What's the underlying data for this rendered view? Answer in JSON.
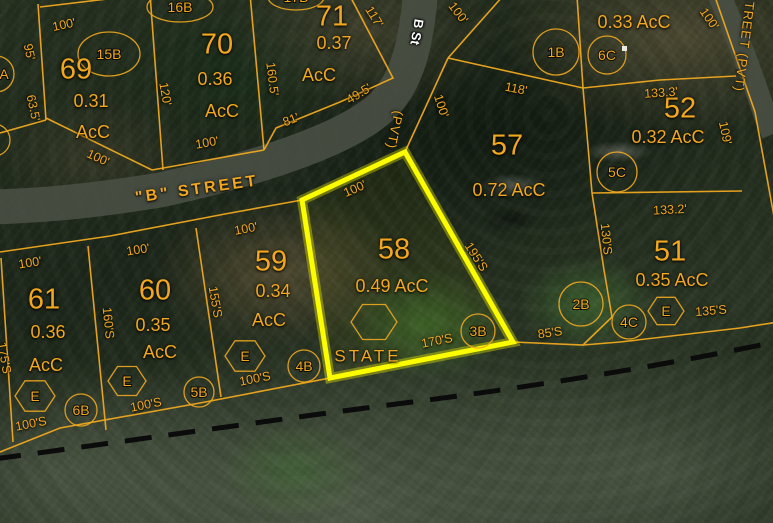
{
  "map": {
    "colors": {
      "boundary": "#efa81f",
      "highlight": "#fcfc00",
      "road": "#4a5044",
      "dashed_line": "#0b0b0b",
      "label": "#f2a71e",
      "street_label_white": "#ffffff"
    },
    "roads": [
      {
        "name": "b-street",
        "path": "M 421,-12 C 417,38 409,84 378,110 C 340,142 252,170 160,190 C 80,203 30,206 -10,207",
        "width": 35
      },
      {
        "name": "right-street",
        "path": "M 717,-10 C 735,30 752,75 766,118 L 773,134",
        "width": 23
      }
    ],
    "boundaries": [
      "38,4 46,120",
      "40,7 132,-4",
      "150,-6 163,170",
      "250,-6 264,150",
      "350,-4 393,78 340,102 276,128 264,150",
      "46,118 152,170",
      "152,170 264,150",
      "46,120 0,133",
      "0,252 110,236 225,214 302,200",
      "1,258 13,442",
      "88,246 106,430",
      "196,228 221,397",
      "0,452 60,428 200,403 330,378",
      "448,58 405,152",
      "448,58 503,-4",
      "448,58 583,88",
      "577,-4 583,88 592,193",
      "583,88 660,80 736,76",
      "592,193 742,191",
      "592,193 604,270 612,317",
      "612,317 583,345 513,342",
      "583,345 620,342 740,328 778,322",
      "714,-6 755,112 781,255"
    ],
    "highlight_parcel": {
      "parcel": "58",
      "points": "302,200 405,152 513,342 330,378"
    },
    "dashed_boundary": {
      "path": "M -6,459 C 150,438 300,416 420,401 C 560,383 680,362 780,341"
    },
    "circles": [
      {
        "label": "1B",
        "cx": 556,
        "cy": 52,
        "r": 23
      },
      {
        "label": "6C",
        "cx": 607,
        "cy": 55,
        "r": 19
      },
      {
        "label": "5C",
        "cx": 617,
        "cy": 172,
        "r": 20
      },
      {
        "label": "2B",
        "cx": 581,
        "cy": 304,
        "r": 22
      },
      {
        "label": "4C",
        "cx": 629,
        "cy": 322,
        "r": 17
      },
      {
        "label": "3B",
        "cx": 478,
        "cy": 331,
        "r": 17
      },
      {
        "label": "4B",
        "cx": 304,
        "cy": 366,
        "r": 16
      },
      {
        "label": "5B",
        "cx": 199,
        "cy": 392,
        "r": 15
      },
      {
        "label": "6B",
        "cx": 81,
        "cy": 410,
        "r": 16
      },
      {
        "label": "A",
        "cx": -4,
        "cy": 74,
        "r": 18,
        "lx": 4
      },
      {
        "label": "",
        "cx": -6,
        "cy": 140,
        "r": 16
      }
    ],
    "ellipses": [
      {
        "label": "15B",
        "cx": 109,
        "cy": 54,
        "rx": 31,
        "ry": 22
      },
      {
        "label": "16B",
        "cx": 180,
        "cy": 7,
        "rx": 33,
        "ry": 15
      },
      {
        "label": "17B",
        "cx": 296,
        "cy": -3,
        "rx": 28,
        "ry": 13
      }
    ],
    "hexagons": [
      {
        "label": "",
        "cx": 374,
        "cy": 322,
        "r": 23
      },
      {
        "label": "E",
        "cx": 35,
        "cy": 396,
        "r": 20
      },
      {
        "label": "E",
        "cx": 127,
        "cy": 381,
        "r": 19
      },
      {
        "label": "E",
        "cx": 245,
        "cy": 356,
        "r": 20
      },
      {
        "label": "E",
        "cx": 666,
        "cy": 311,
        "r": 18
      }
    ],
    "labels": [
      {
        "text": "69",
        "x": 76,
        "y": 70,
        "rot": 0,
        "cls": "num"
      },
      {
        "text": "70",
        "x": 217,
        "y": 45,
        "rot": 0,
        "cls": "num"
      },
      {
        "text": "71",
        "x": 332,
        "y": 17,
        "rot": 0,
        "cls": "num"
      },
      {
        "text": "57",
        "x": 507,
        "y": 146,
        "rot": 0,
        "cls": "num"
      },
      {
        "text": "58",
        "x": 394,
        "y": 250,
        "rot": 0,
        "cls": "num"
      },
      {
        "text": "52",
        "x": 680,
        "y": 109,
        "rot": 0,
        "cls": "num"
      },
      {
        "text": "51",
        "x": 670,
        "y": 252,
        "rot": 0,
        "cls": "num"
      },
      {
        "text": "61",
        "x": 44,
        "y": 300,
        "rot": 0,
        "cls": "num"
      },
      {
        "text": "60",
        "x": 155,
        "y": 291,
        "rot": 0,
        "cls": "num"
      },
      {
        "text": "59",
        "x": 271,
        "y": 262,
        "rot": 0,
        "cls": "num"
      },
      {
        "text": "0.31",
        "x": 91,
        "y": 101,
        "rot": 0,
        "cls": "acr"
      },
      {
        "text": "AcC",
        "x": 93,
        "y": 132,
        "rot": 0,
        "cls": "acr"
      },
      {
        "text": "0.36",
        "x": 215,
        "y": 79,
        "rot": 0,
        "cls": "acr"
      },
      {
        "text": "AcC",
        "x": 222,
        "y": 111,
        "rot": 0,
        "cls": "acr"
      },
      {
        "text": "0.37",
        "x": 334,
        "y": 43,
        "rot": 0,
        "cls": "acr"
      },
      {
        "text": "AcC",
        "x": 319,
        "y": 75,
        "rot": 0,
        "cls": "acr"
      },
      {
        "text": "0.72 AcC",
        "x": 509,
        "y": 190,
        "rot": 0,
        "cls": "acr"
      },
      {
        "text": "0.49 AcC",
        "x": 392,
        "y": 286,
        "rot": 0,
        "cls": "acr"
      },
      {
        "text": "0.33 AcC",
        "x": 634,
        "y": 22,
        "rot": 0,
        "cls": "acr"
      },
      {
        "text": "0.32 AcC",
        "x": 668,
        "y": 137,
        "rot": 0,
        "cls": "acr"
      },
      {
        "text": "0.35 AcC",
        "x": 672,
        "y": 280,
        "rot": 0,
        "cls": "acr"
      },
      {
        "text": "0.36",
        "x": 48,
        "y": 332,
        "rot": 0,
        "cls": "acr"
      },
      {
        "text": "AcC",
        "x": 46,
        "y": 365,
        "rot": 0,
        "cls": "acr"
      },
      {
        "text": "0.35",
        "x": 153,
        "y": 325,
        "rot": 0,
        "cls": "acr"
      },
      {
        "text": "AcC",
        "x": 160,
        "y": 352,
        "rot": 0,
        "cls": "acr"
      },
      {
        "text": "0.34",
        "x": 273,
        "y": 291,
        "rot": 0,
        "cls": "acr"
      },
      {
        "text": "AcC",
        "x": 269,
        "y": 320,
        "rot": 0,
        "cls": "acr"
      },
      {
        "text": "100'",
        "x": 64,
        "y": 25,
        "rot": -12,
        "cls": "dim"
      },
      {
        "text": "95'",
        "x": 29,
        "y": 52,
        "rot": 78,
        "cls": "dim"
      },
      {
        "text": "63.5'",
        "x": 33,
        "y": 108,
        "rot": 78,
        "cls": "dim"
      },
      {
        "text": "100'",
        "x": 98,
        "y": 158,
        "rot": 24,
        "cls": "dim"
      },
      {
        "text": "120'",
        "x": 165,
        "y": 94,
        "rot": 80,
        "cls": "dim"
      },
      {
        "text": "100'",
        "x": 207,
        "y": 143,
        "rot": -10,
        "cls": "dim"
      },
      {
        "text": "117'",
        "x": 374,
        "y": 17,
        "rot": 58,
        "cls": "dim"
      },
      {
        "text": "160.5'",
        "x": 272,
        "y": 79,
        "rot": 83,
        "cls": "dim"
      },
      {
        "text": "49.5'",
        "x": 359,
        "y": 94,
        "rot": -32,
        "cls": "dim"
      },
      {
        "text": "81'",
        "x": 291,
        "y": 120,
        "rot": -22,
        "cls": "dim"
      },
      {
        "text": "100'",
        "x": 458,
        "y": 13,
        "rot": 52,
        "cls": "dim"
      },
      {
        "text": "100'",
        "x": 441,
        "y": 106,
        "rot": 72,
        "cls": "dim"
      },
      {
        "text": "118'",
        "x": 516,
        "y": 89,
        "rot": 11,
        "cls": "dim"
      },
      {
        "text": "100'",
        "x": 709,
        "y": 19,
        "rot": 55,
        "cls": "dim"
      },
      {
        "text": "133.3'",
        "x": 661,
        "y": 93,
        "rot": -4,
        "cls": "dim"
      },
      {
        "text": "109'",
        "x": 725,
        "y": 133,
        "rot": 78,
        "cls": "dim"
      },
      {
        "text": "133.2'",
        "x": 670,
        "y": 210,
        "rot": -3,
        "cls": "dim"
      },
      {
        "text": "130'S",
        "x": 606,
        "y": 239,
        "rot": 84,
        "cls": "dim"
      },
      {
        "text": "195'S",
        "x": 476,
        "y": 257,
        "rot": 57,
        "cls": "dim"
      },
      {
        "text": "100'",
        "x": 355,
        "y": 189,
        "rot": -24,
        "cls": "dim"
      },
      {
        "text": "170'S",
        "x": 437,
        "y": 341,
        "rot": -11,
        "cls": "dim"
      },
      {
        "text": "135'S",
        "x": 711,
        "y": 311,
        "rot": -5,
        "cls": "dim"
      },
      {
        "text": "85'S",
        "x": 550,
        "y": 333,
        "rot": -8,
        "cls": "dim"
      },
      {
        "text": "100'",
        "x": 30,
        "y": 263,
        "rot": -9,
        "cls": "dim"
      },
      {
        "text": "100'",
        "x": 138,
        "y": 250,
        "rot": -9,
        "cls": "dim"
      },
      {
        "text": "100'",
        "x": 246,
        "y": 229,
        "rot": -11,
        "cls": "dim"
      },
      {
        "text": "175'S",
        "x": 4,
        "y": 358,
        "rot": 80,
        "cls": "dim"
      },
      {
        "text": "160'S",
        "x": 108,
        "y": 323,
        "rot": 84,
        "cls": "dim"
      },
      {
        "text": "155'S",
        "x": 215,
        "y": 302,
        "rot": 80,
        "cls": "dim"
      },
      {
        "text": "100'S",
        "x": 31,
        "y": 424,
        "rot": -11,
        "cls": "dim"
      },
      {
        "text": "100'S",
        "x": 146,
        "y": 405,
        "rot": -11,
        "cls": "dim"
      },
      {
        "text": "100'S",
        "x": 255,
        "y": 379,
        "rot": -11,
        "cls": "dim"
      },
      {
        "text": "\"B\"  STREET",
        "x": 197,
        "y": 190,
        "rot": -8,
        "cls": "street"
      },
      {
        "text": "STATE",
        "x": 368,
        "y": 356,
        "rot": 0,
        "cls": "state"
      },
      {
        "text": "B St",
        "x": 417,
        "y": 32,
        "rot": 100,
        "cls": "stwhite"
      },
      {
        "text": "(PVT)",
        "x": 395,
        "y": 130,
        "rot": 102,
        "cls": "pvt"
      },
      {
        "text": "STREET  (PVT)",
        "x": 745,
        "y": 42,
        "rot": 97,
        "cls": "pvt"
      }
    ]
  }
}
